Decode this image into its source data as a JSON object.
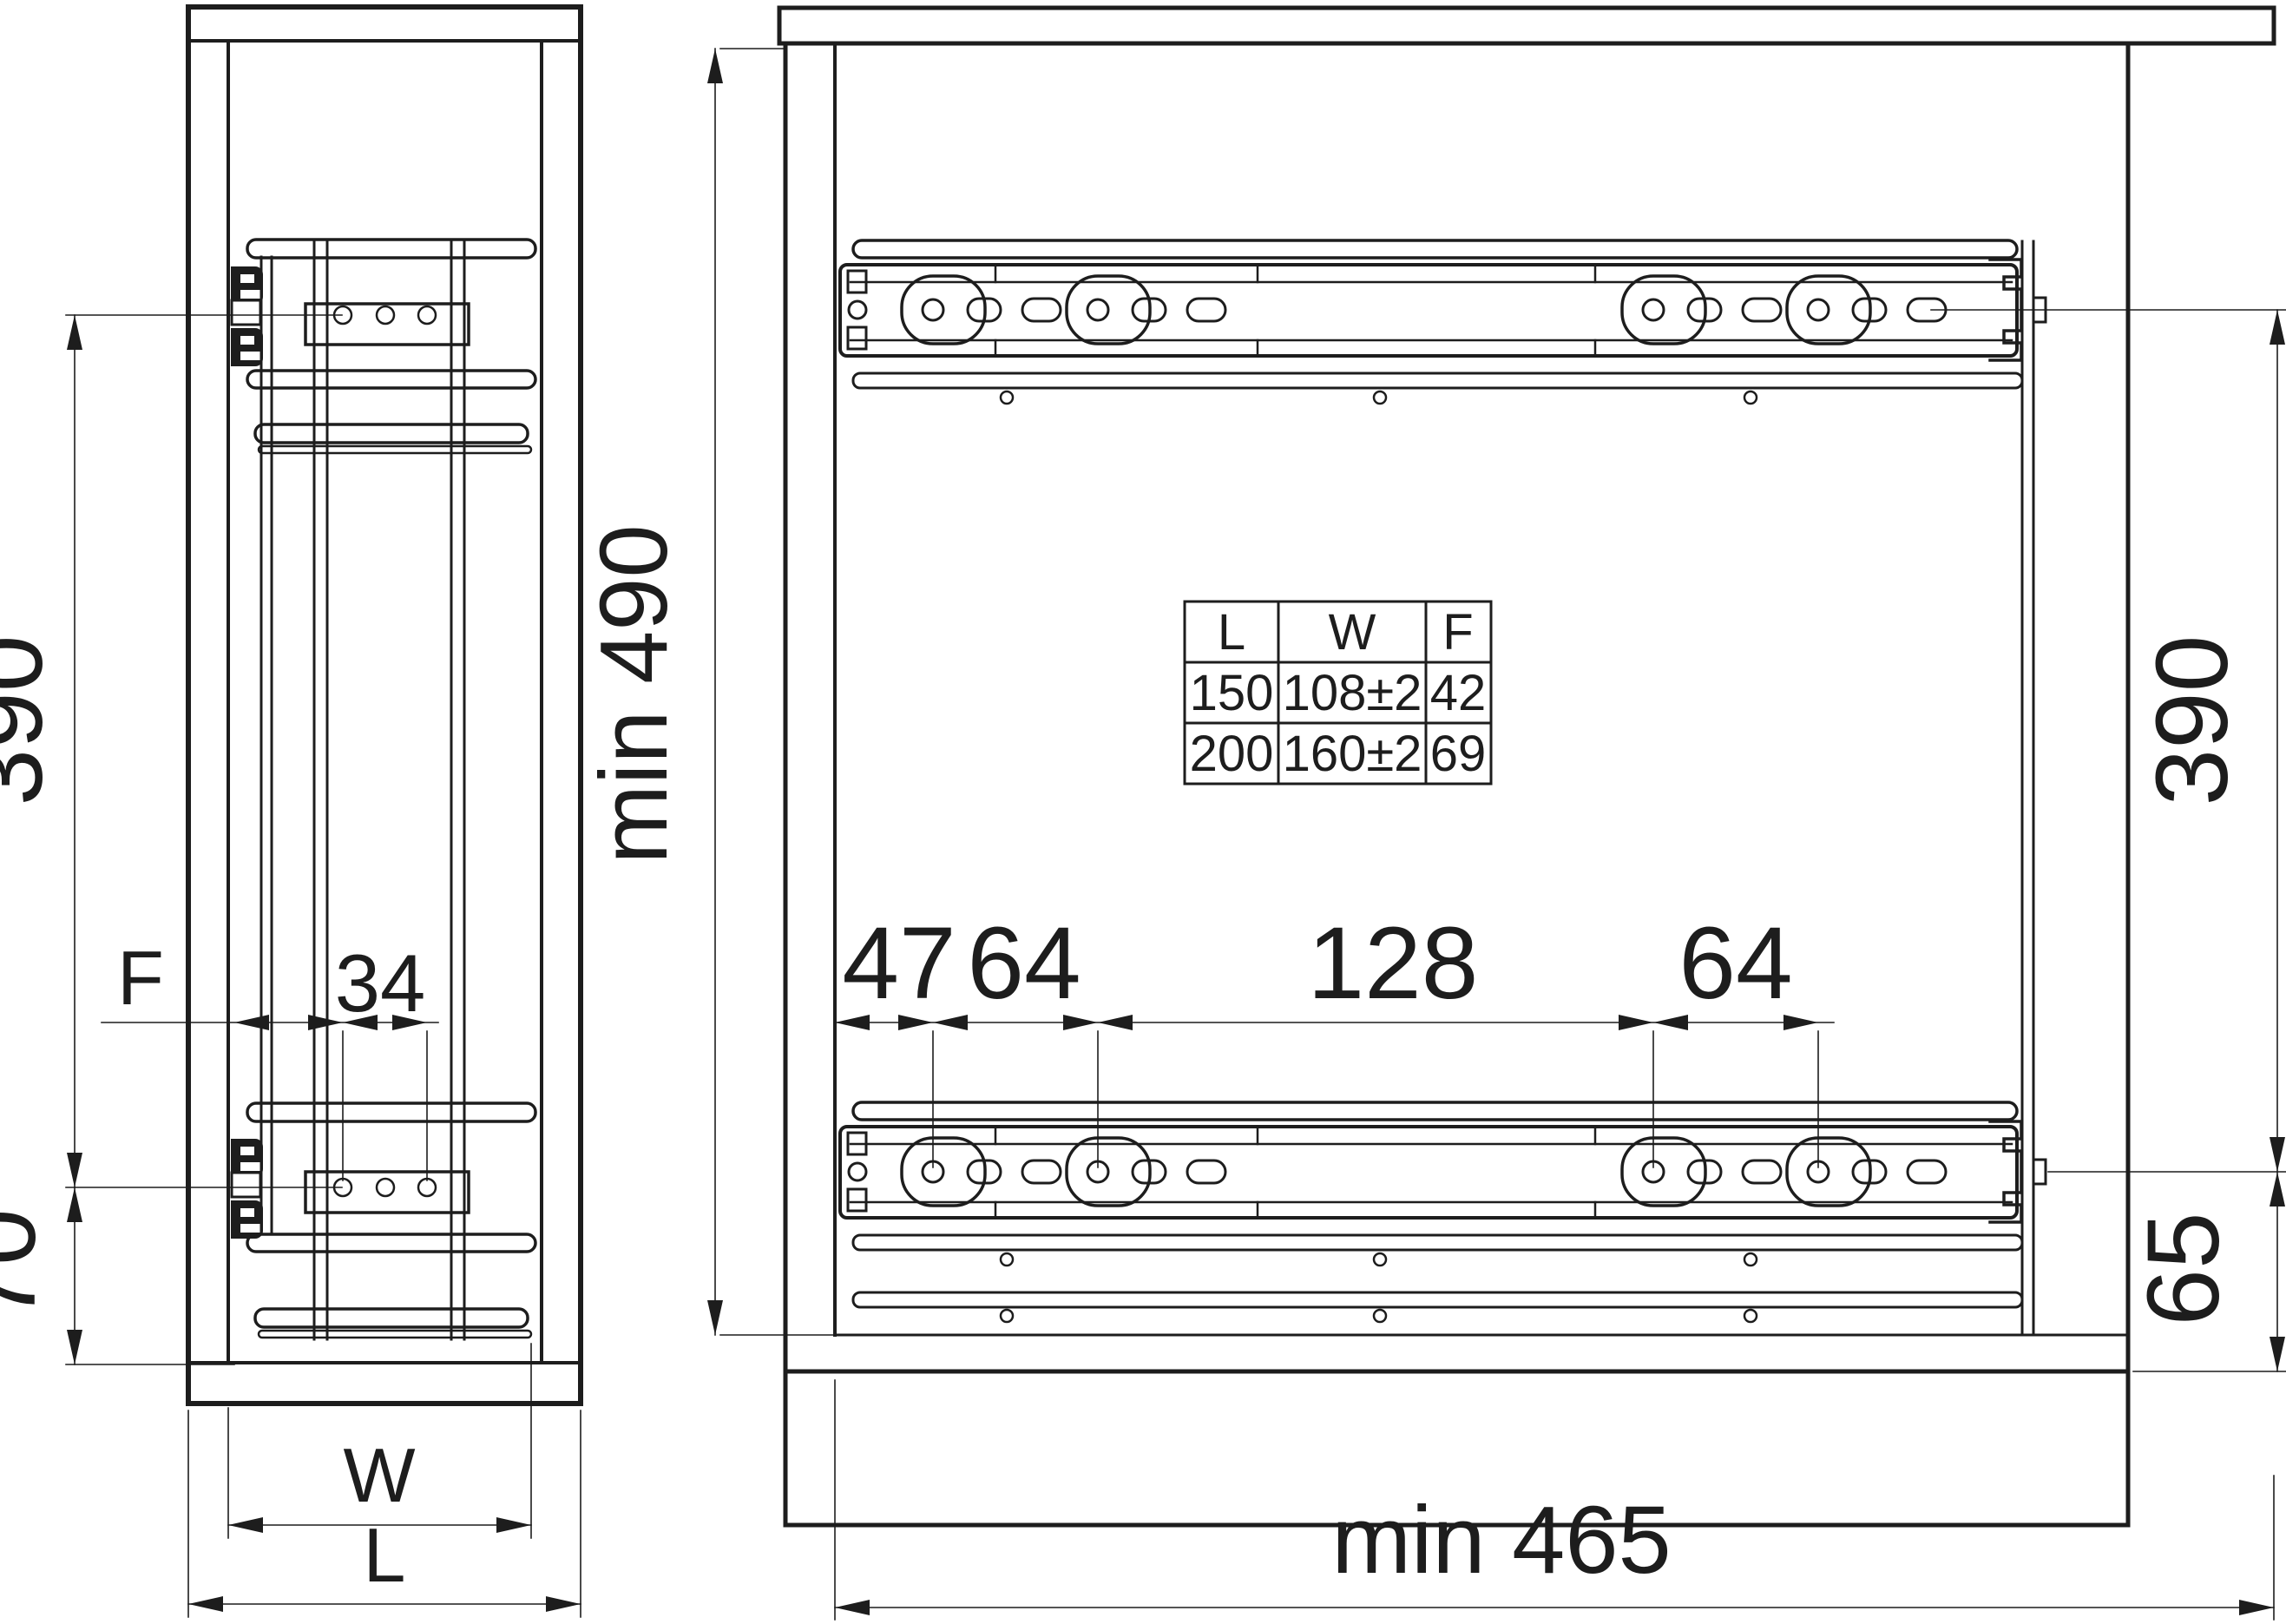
{
  "drawing": {
    "front_view": {
      "dim_height_390": "390",
      "dim_bottom_70": "70",
      "dim_front_offset": "F",
      "dim_hole_spacing_34": "34",
      "dim_width_W": "W",
      "dim_length_L": "L"
    },
    "side_view": {
      "dim_min_height": "min 490",
      "dim_first_hole_47": "47",
      "dim_hole_64_left": "64",
      "dim_hole_128": "128",
      "dim_hole_64_right": "64",
      "dim_height_390": "390",
      "dim_bottom_65": "65",
      "dim_min_depth": "min 465"
    },
    "spec_table": {
      "headers": [
        "L",
        "W",
        "F"
      ],
      "rows": [
        [
          "150",
          "108±2",
          "42"
        ],
        [
          "200",
          "160±2",
          "69"
        ]
      ]
    },
    "colors": {
      "line": "#1d1d1d",
      "background": "#ffffff"
    }
  }
}
